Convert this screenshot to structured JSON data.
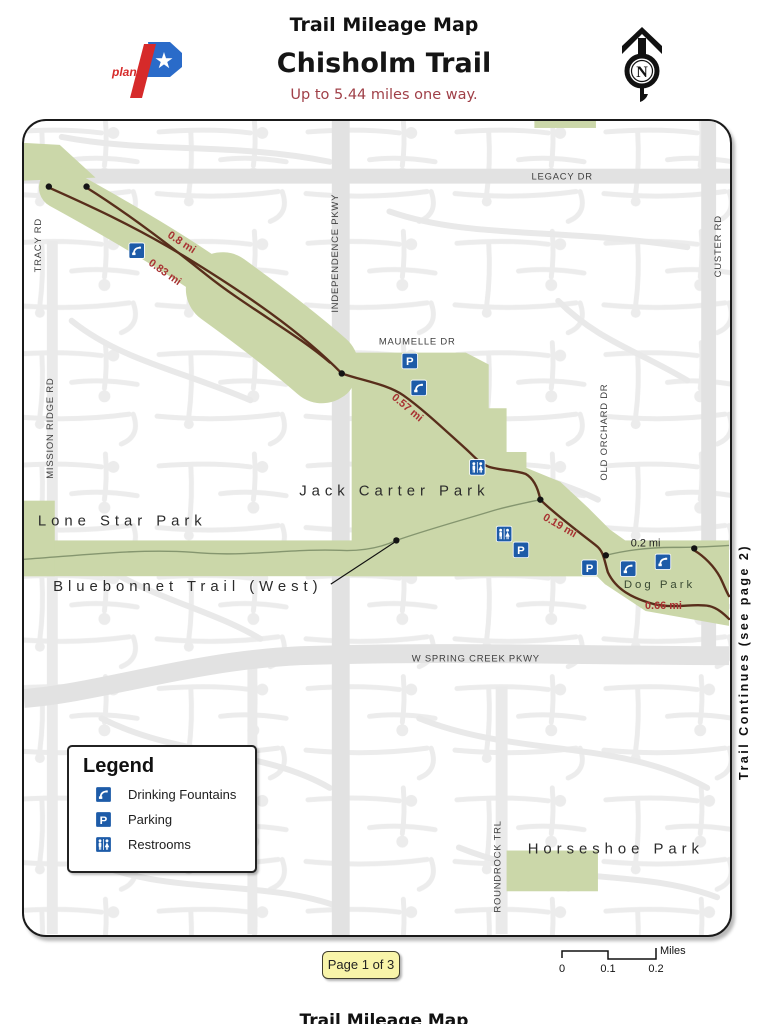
{
  "header": {
    "title": "Trail Mileage Map",
    "trail_name": "Chisholm Trail",
    "tagline": "Up to 5.44 miles one way.",
    "logo_text": "plano",
    "compass_letter": "N"
  },
  "map": {
    "streets": {
      "tracy": "TRACY RD",
      "mission_ridge": "MISSION RIDGE RD",
      "independence": "INDEPENDENCE PKWY",
      "legacy": "LEGACY DR",
      "maumelle": "MAUMELLE DR",
      "old_orchard": "OLD ORCHARD DR",
      "custer": "CUSTER RD",
      "spring_creek": "W SPRING CREEK PKWY",
      "roundrock": "ROUNDROCK TRL"
    },
    "parks": {
      "jack_carter": "Jack Carter Park",
      "lone_star": "Lone Star Park",
      "horseshoe": "Horseshoe Park",
      "dog_park": "Dog Park"
    },
    "trail_labels": {
      "bluebonnet": "Bluebonnet Trail (West)",
      "continues": "Trail Continues (see page 2)"
    },
    "mileage": {
      "m08": "0.8 mi",
      "m083": "0.83 mi",
      "m057": "0.57 mi",
      "m019": "0.19 mi",
      "m02": "0.2 mi",
      "m066": "0.66 mi"
    },
    "map_icons": [
      "drinking-fountain-icon",
      "parking-icon",
      "drinking-fountain-icon",
      "restroom-icon",
      "restroom-icon",
      "parking-icon",
      "parking-icon",
      "drinking-fountain-icon",
      "drinking-fountain-icon"
    ]
  },
  "legend": {
    "title": "Legend",
    "items": [
      {
        "icon": "drinking-fountain-icon",
        "label": "Drinking Fountains"
      },
      {
        "icon": "parking-icon",
        "label": "Parking"
      },
      {
        "icon": "restroom-icon",
        "label": "Restrooms"
      }
    ]
  },
  "footer": {
    "page_label": "Page 1 of 3",
    "scale_ticks": [
      "0",
      "0.1",
      "0.2"
    ],
    "scale_unit": "Miles",
    "next_page_title": "Trail Mileage Map"
  },
  "colors": {
    "park_green": "#cbd7a9",
    "trail_brown": "#582e1b",
    "mileage_red": "#a83232",
    "icon_blue": "#1d5ba8",
    "page_box_yellow": "#f8f4a9"
  }
}
